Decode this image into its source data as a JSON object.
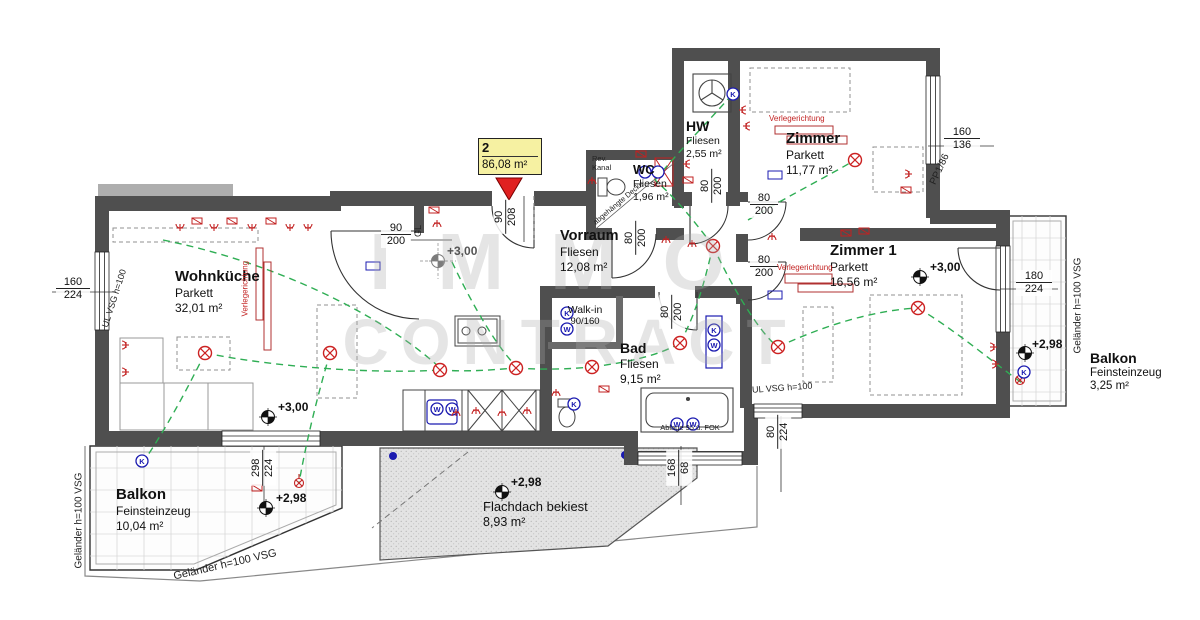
{
  "unit": {
    "number": "2",
    "area": "86,08 m²"
  },
  "watermark": {
    "line1": "IMMO",
    "line2": "CONTRACT"
  },
  "rooms": {
    "wohnkueche": {
      "name": "Wohnküche",
      "floor": "Parkett",
      "area": "32,01 m²"
    },
    "vorraum": {
      "name": "Vorraum",
      "floor": "Fliesen",
      "area": "12,08 m²"
    },
    "wc": {
      "name": "WC",
      "floor": "Fliesen",
      "area": "1,96 m²"
    },
    "hw": {
      "name": "HW",
      "floor": "Fliesen",
      "area": "2,55 m²"
    },
    "zimmer": {
      "name": "Zimmer",
      "floor": "Parkett",
      "area": "11,77 m²"
    },
    "zimmer1": {
      "name": "Zimmer 1",
      "floor": "Parkett",
      "area": "16,56 m²"
    },
    "bad": {
      "name": "Bad",
      "floor": "Fliesen",
      "area": "9,15 m²"
    },
    "balkon_sw": {
      "name": "Balkon",
      "floor": "Feinsteinzeug",
      "area": "10,04 m²"
    },
    "balkon_ost": {
      "name": "Balkon",
      "floor": "Feinsteinzeug",
      "area": "3,25 m²"
    },
    "flachdach": {
      "name": "Flachdach bekiest",
      "area": "8,93 m²"
    }
  },
  "levels": {
    "wohnkueche": "+3,00",
    "vorraum": "+3,00",
    "zimmer1": "+3,00",
    "balkon_sw": "+2,98",
    "flachdach": "+2,98",
    "balkon_ost": "+2,98"
  },
  "dimensions": {
    "fenster_links": {
      "num": "160",
      "den": "224"
    },
    "eingang": {
      "num": "90",
      "den": "208"
    },
    "tuer_wohnkueche": {
      "num": "90",
      "den": "200"
    },
    "tuer_wc": {
      "num": "80",
      "den": "200"
    },
    "tuer_hw": {
      "num": "80",
      "den": "200"
    },
    "tuer_zimmer": {
      "num": "80",
      "den": "200"
    },
    "tuer_zimmer1": {
      "num": "80",
      "den": "200"
    },
    "tuer_bad": {
      "num": "80",
      "den": "200"
    },
    "fenster_zimmer": {
      "num": "160",
      "den": "136"
    },
    "tuer_balkon_ost": {
      "num": "180",
      "den": "224"
    },
    "tuer_balkon_sw": {
      "num": "298",
      "den": "224"
    },
    "fenster_bad": {
      "num": "168",
      "den": "68"
    },
    "fenster_gang": {
      "num": "80",
      "den": "224"
    }
  },
  "annotations": {
    "walkin_name": "Walk-in",
    "walkin_size": "90/160",
    "ablage": "Ablage 95 ü. FOK",
    "rev_kanal": "Rev. Kanal",
    "abgehaengte_decke": "abgehängte Decke",
    "gelaender": "Geländer h=100 VSG",
    "ul_vsg": "UL VSG h=100",
    "pp1": "PP1/86",
    "verlegerichtung": "Verlegerichtung",
    "gl": "GL"
  },
  "symbols": {
    "k": "K",
    "w": "W"
  }
}
